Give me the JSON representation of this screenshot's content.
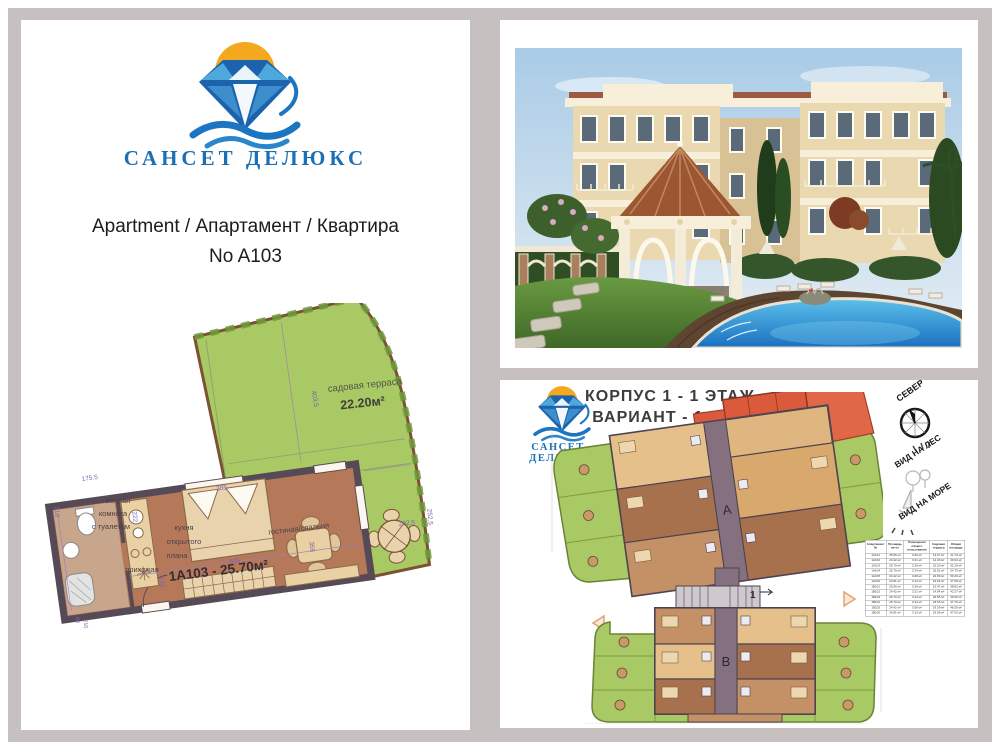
{
  "brand": {
    "name": "САНСЕТ ДЕЛЮКС"
  },
  "colors": {
    "accent_blue": "#1b6fb5",
    "sun_orange": "#f3a81f",
    "terrace_green": "#a9c964",
    "highlight_red": "#db5a3c",
    "wall_dark": "#574a57",
    "floor_tan": "#b5795a"
  },
  "left_panel": {
    "title_line1": "Apartment / Апартамент / Квартира",
    "title_line2": "No A103",
    "floorplan": {
      "terrace_name": "садовая терраса",
      "terrace_area": "22.20м²",
      "apartment_code": "1А103 - 25.70м²",
      "rooms": {
        "bathroom": [
          "ванная",
          "комната",
          "с туалетом"
        ],
        "kitchen": [
          "кухня",
          "открытого",
          "плана"
        ],
        "hallway": "прихожая",
        "living": "гостиная/спальня"
      },
      "dims": {
        "d210": "210",
        "d175": "175.5",
        "d222": "222",
        "d385": "385",
        "d605": "605",
        "d133": "133",
        "d355": "355",
        "d403": "403.5",
        "d292": "292.5",
        "d252": "252.5",
        "d90": "90",
        "d210b": "210"
      }
    }
  },
  "plan_panel": {
    "title_line1": "КОРПУС 1  - 1 ЭТАЖ",
    "title_line2": "ВАРИАНТ - 1",
    "compass_label": "СЕВЕР",
    "view_forest": "ВИД НА ЛЕС",
    "view_sea": "ВИД НА МОРЕ",
    "block_a": "A",
    "block_b": "B",
    "entrance": "1",
    "table": {
      "headers": [
        "Апартамент №",
        "Площадь нетто",
        "Помещения общего пользования",
        "Садовая терраса",
        "Общая площадь"
      ],
      "rows": [
        [
          "1A101",
          "25.06 м²",
          "3.29 м²",
          "13.27 м²",
          "41.73 м²"
        ],
        [
          "1A102",
          "24.42 м²",
          "3.21 м²",
          "12.30 м²",
          "39.93 м²"
        ],
        [
          "1A103",
          "25.70 м²",
          "3.39 м²",
          "22.20 м²",
          "51.29 м²"
        ],
        [
          "1A104",
          "25.70 м²",
          "3.24 м²",
          "25.81 м²",
          "54.75 м²"
        ],
        [
          "1A105",
          "24.42 м²",
          "3.08 м²",
          "22.99 м²",
          "50.49 м²"
        ],
        [
          "1A106",
          "24.81 м²",
          "3.13 м²",
          "19.64 м²",
          "47.58 м²"
        ],
        [
          "1B101",
          "25.06 м²",
          "3.29 м²",
          "10.47 м²",
          "38.82 м²"
        ],
        [
          "1B102",
          "24.42 м²",
          "3.21 м²",
          "14.64 м²",
          "42.27 м²"
        ],
        [
          "1B103",
          "25.70 м²",
          "3.44 м²",
          "20.55 м²",
          "49.69 м²"
        ],
        [
          "1B104",
          "25.70 м²",
          "3.44 м²",
          "18.56 м²",
          "47.70 м²"
        ],
        [
          "1B105",
          "24.42 м²",
          "3.08 м²",
          "19.09 м²",
          "46.59 м²"
        ],
        [
          "1B106",
          "24.81 м²",
          "3.13 м²",
          "19.59 м²",
          "47.53 м²"
        ]
      ]
    }
  }
}
